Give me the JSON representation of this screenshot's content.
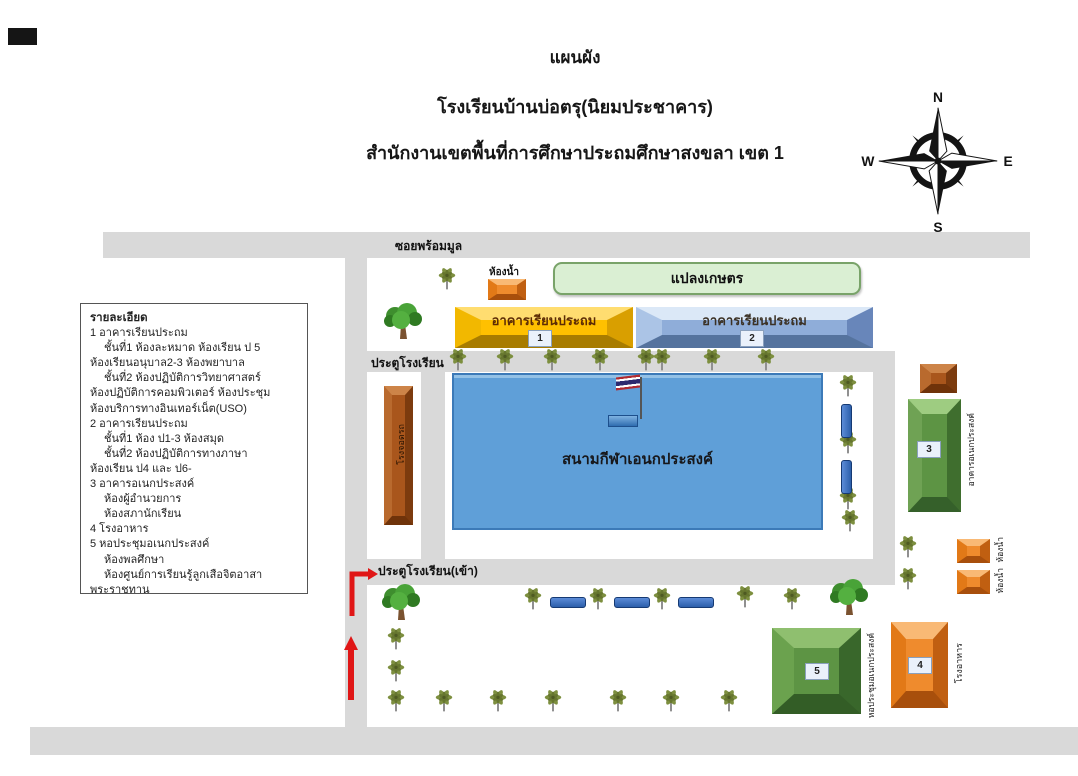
{
  "title": {
    "line1": "แผนผัง",
    "line2": "โรงเรียนบ้านบ่อตรุ(นิยมประชาคาร)",
    "line3": "สำนักงานเขตพื้นที่การศึกษาประถมศึกษาสงขลา เขต 1"
  },
  "compass": {
    "north": "N",
    "east": "E",
    "south": "S",
    "west": "W"
  },
  "legend": {
    "title": "รายละเอียด",
    "lines": [
      {
        "text": "1 อาคารเรียนประถม",
        "indent": 0
      },
      {
        "text": "ชั้นที่1 ห้องละหมาด ห้องเรียน ป 5",
        "indent": 1
      },
      {
        "text": "ห้องเรียนอนุบาล2-3 ห้องพยาบาล",
        "indent": 0
      },
      {
        "text": "ชั้นที่2 ห้องปฏิบัติการวิทยาศาสตร์",
        "indent": 1
      },
      {
        "text": "ห้องปฏิบัติการคอมพิวเตอร์ ห้องประชุม",
        "indent": 0
      },
      {
        "text": "ห้องบริการทางอินเทอร์เน็ต(USO)",
        "indent": 0
      },
      {
        "text": "2 อาคารเรียนประถม",
        "indent": 0
      },
      {
        "text": "ชั้นที่1 ห้อง ป1-3  ห้องสมุด",
        "indent": 1
      },
      {
        "text": "ชั้นที่2 ห้องปฏิบัติการทางภาษา",
        "indent": 1
      },
      {
        "text": "ห้องเรียน ป4 และ ป6-",
        "indent": 0
      },
      {
        "text": "3 อาคารอเนกประสงค์",
        "indent": 0
      },
      {
        "text": "ห้องผู้อำนวยการ",
        "indent": 1
      },
      {
        "text": "ห้องสภานักเรียน",
        "indent": 1
      },
      {
        "text": "4 โรงอาหาร",
        "indent": 0
      },
      {
        "text": "5 หอประชุมอเนกประสงค์",
        "indent": 0
      },
      {
        "text": "ห้องพลศึกษา",
        "indent": 1
      },
      {
        "text": "ห้องศูนย์การเรียนรู้ลูกเสือจิตอาสา",
        "indent": 1
      },
      {
        "text": "พระราชทาน",
        "indent": 0
      }
    ]
  },
  "map": {
    "soi_label": "ซอยพร้อมมูล",
    "gate_top_label": "ประตูโรงเรียน",
    "gate_bottom_label": "ประตูโรงเรียน(เข้า)",
    "toilet_top_label": "ห้องน้ำ",
    "agri_label": "แปลงเกษตร",
    "building1": {
      "label": "อาคารเรียนประถม",
      "number": "1"
    },
    "building2": {
      "label": "อาคารเรียนประถม",
      "number": "2"
    },
    "parking_label": "โรงจอดรถ",
    "field_label": "สนามกีฬาเอนกประสงค์",
    "building3": {
      "number": "3",
      "side_label": "อาคารอเนกประสงค์"
    },
    "building4": {
      "number": "4",
      "side_label": "โรงอาหาร"
    },
    "building5": {
      "number": "5",
      "side_label": "หอประชุมอเนกประสงค์"
    },
    "toilet_right1_label": "ห้องน้ำ",
    "toilet_right2_label": "ห้องน้ำ"
  },
  "colors": {
    "road": "#d9d9d9",
    "yellow": "#ffc000",
    "blue2": "#8fadd9",
    "field": "#5f9fd8",
    "green": "#5d9444",
    "orange": "#ef8b2d",
    "brown": "#a9561c",
    "agri": "#daefd3",
    "bench": "#2c5faa",
    "red": "#e01616"
  }
}
